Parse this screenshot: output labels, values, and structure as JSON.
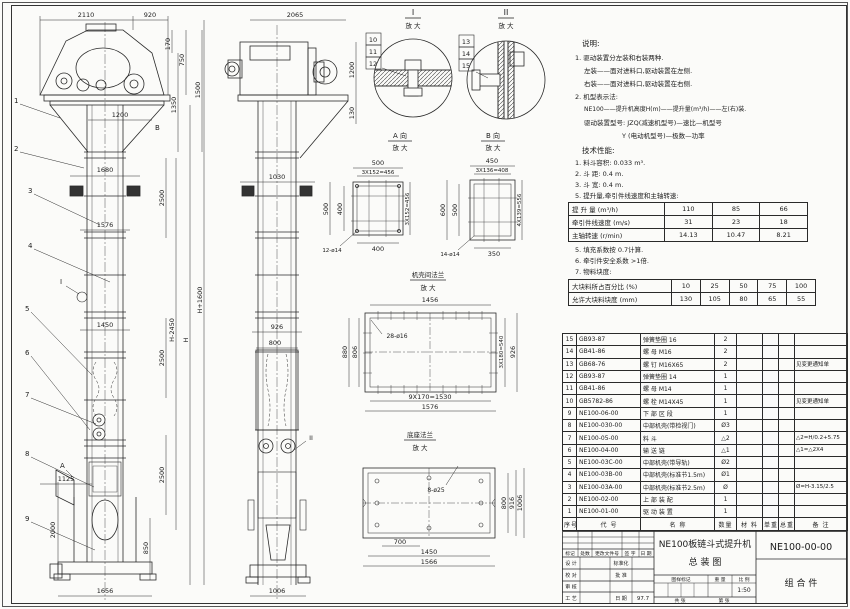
{
  "notes": {
    "heading": "说明:",
    "l1": "1. 驱动装置分左装和右装两种.",
    "l2": "左装——面对进料口,驱动装置在左侧.",
    "l3": "右装——面对进料口,驱动装置在右侧.",
    "l4": "2. 机型表示法:",
    "l5": "NE100——提升机高度H(m)——提升量(m³/h)——左(右)装.",
    "l6": "驱动装置型号: JZQ(减速机型号)—速比—机型号",
    "l7": "Y (电动机型号)—极数—功率"
  },
  "tech": {
    "heading": "技术性能:",
    "l1": "1. 料斗容积: 0.033 m³.",
    "l2": "2. 斗  距: 0.4 m.",
    "l3": "3. 斗  宽: 0.4 m.",
    "l4": "5. 提升量,牵引件线速度和主轴转速:",
    "l5": "5. 填充系数按 0.7计算.",
    "l6": "6. 牵引件安全系数 >1倍.",
    "l7": "7. 物料块度:"
  },
  "spec1": {
    "rows": [
      [
        "提 升 量  (m³/h)",
        "110",
        "85",
        "66"
      ],
      [
        "牵引件线速度 (m/s)",
        "31",
        "23",
        "18"
      ],
      [
        "主轴转速 (r/min)",
        "14.13",
        "10.47",
        "8.21"
      ]
    ]
  },
  "spec2": {
    "rows": [
      [
        "大块料所占百分比 (%)",
        "10",
        "25",
        "50",
        "75",
        "100"
      ],
      [
        "允许大块料块度 (mm)",
        "130",
        "105",
        "80",
        "65",
        "55"
      ]
    ]
  },
  "bom": {
    "headers": [
      "序号",
      "代  号",
      "名  称",
      "数量",
      "材 料",
      "单重",
      "总重",
      "备 注"
    ],
    "rows": [
      [
        "15",
        "GB93-87",
        "弹簧垫圈 16",
        "2",
        "",
        "",
        "",
        ""
      ],
      [
        "14",
        "GB41-86",
        "螺 母 M16",
        "2",
        "",
        "",
        "",
        ""
      ],
      [
        "13",
        "GB68-76",
        "螺 钉 M16X65",
        "2",
        "",
        "",
        "",
        "见变更通知单"
      ],
      [
        "12",
        "GB93-87",
        "弹簧垫圈 14",
        "1",
        "",
        "",
        "",
        ""
      ],
      [
        "11",
        "GB41-86",
        "螺 母 M14",
        "1",
        "",
        "",
        "",
        ""
      ],
      [
        "10",
        "GB5782-86",
        "螺 栓 M14X45",
        "1",
        "",
        "",
        "",
        "见变更通知单"
      ],
      [
        "9",
        "NE100-06-00",
        "下 部 区 段",
        "1",
        "",
        "",
        "",
        ""
      ],
      [
        "8",
        "NE100-030-00",
        "中部机壳(带检视门)",
        "Ø3",
        "",
        "",
        "",
        ""
      ],
      [
        "7",
        "NE100-05-00",
        "料 斗",
        "△2",
        "",
        "",
        "",
        "△2=H/0.2+5.75"
      ],
      [
        "6",
        "NE100-04-00",
        "输 送 链",
        "△1",
        "",
        "",
        "",
        "△1=△2X4"
      ],
      [
        "5",
        "NE100-03C-00",
        "中部机壳(带导轨)",
        "Ø2",
        "",
        "",
        "",
        ""
      ],
      [
        "4",
        "NE100-03B-00",
        "中部机壳(标准节1.5m)",
        "Ø1",
        "",
        "",
        "",
        ""
      ],
      [
        "3",
        "NE100-03A-00",
        "中部机壳(标准节2.5m)",
        "Ø",
        "",
        "",
        "",
        "Ø=H-3.15/2.5"
      ],
      [
        "2",
        "NE100-02-00",
        "上 部 装 配",
        "1",
        "",
        "",
        "",
        ""
      ],
      [
        "1",
        "NE100-01-00",
        "驱 动 装 置",
        "1",
        "",
        "",
        "",
        ""
      ]
    ]
  },
  "titleblock": {
    "title_line1": "NE100板链斗式提升机",
    "title_line2": "总  装  图",
    "drawing_no": "NE100-00-00",
    "part_type": "组 合 件",
    "scale_value": "1:50",
    "date_value": "97.7",
    "r1": [
      "标记",
      "处数",
      "更改文件号",
      "签 字",
      "日 期"
    ],
    "design": "设 计",
    "check": "校 对",
    "review": "审 核",
    "craft": "工 艺",
    "standard": "标准化",
    "approve": "批 准",
    "date_label": "日 期",
    "mark_label": "图样标记",
    "weight_label": "重 量",
    "scale_label": "比 例",
    "sheets": "共  张",
    "page": "第  张"
  },
  "labels": {
    "detail1": "I",
    "detail2": "II",
    "enlarge": "放 大",
    "viewA": "A 向",
    "viewB": "B 向",
    "case_flange": "机壳间法兰",
    "base_flange": "底座法兰",
    "markA": "A",
    "markB": "B",
    "markI": "I",
    "markII": "II"
  },
  "balloons": {
    "b1": "1",
    "b2": "2",
    "b3": "3",
    "b4": "4",
    "b5": "5",
    "b6": "6",
    "b7": "7",
    "b8": "8",
    "b9": "9",
    "b10": "10",
    "b11": "11",
    "b12": "12",
    "b13": "13",
    "b14": "14",
    "b15": "15"
  },
  "dims": {
    "fv1": "2110",
    "fv2": "920",
    "fv3": "170",
    "fv4": "750",
    "fv5": "1350",
    "fv6": "1500",
    "fv7": "1200",
    "fv8": "1680",
    "fv9": "2500",
    "fv10": "1576",
    "fv12": "H-2450",
    "fv13": "H",
    "fv14": "H+1600",
    "fv15": "1450",
    "fv17": "1125",
    "fv18": "2000",
    "fv19": "850",
    "fv20": "1656",
    "sv1": "2065",
    "sv2": "1200",
    "sv3": "130",
    "sv4": "1030",
    "sv5": "926",
    "sv6": "800",
    "sv7": "1006",
    "a1": "500",
    "a2": "3X152=456",
    "a3": "500",
    "a4": "400",
    "a5": "3X152=456",
    "a6": "400",
    "a7": "12-ø14",
    "b1": "450",
    "b2": "3X136=408",
    "b3": "600",
    "b4": "500",
    "b5": "4X139=556",
    "b6": "350",
    "b7": "14-ø14",
    "c1": "1456",
    "c2": "28-ø16",
    "c3": "880",
    "c4": "806",
    "c5": "3X180=540",
    "c6": "926",
    "c7": "9X170=1530",
    "c8": "1576",
    "d1": "8-ø25",
    "d2": "800",
    "d3": "916",
    "d4": "1006",
    "d5": "700",
    "d6": "1450",
    "d7": "1566"
  }
}
